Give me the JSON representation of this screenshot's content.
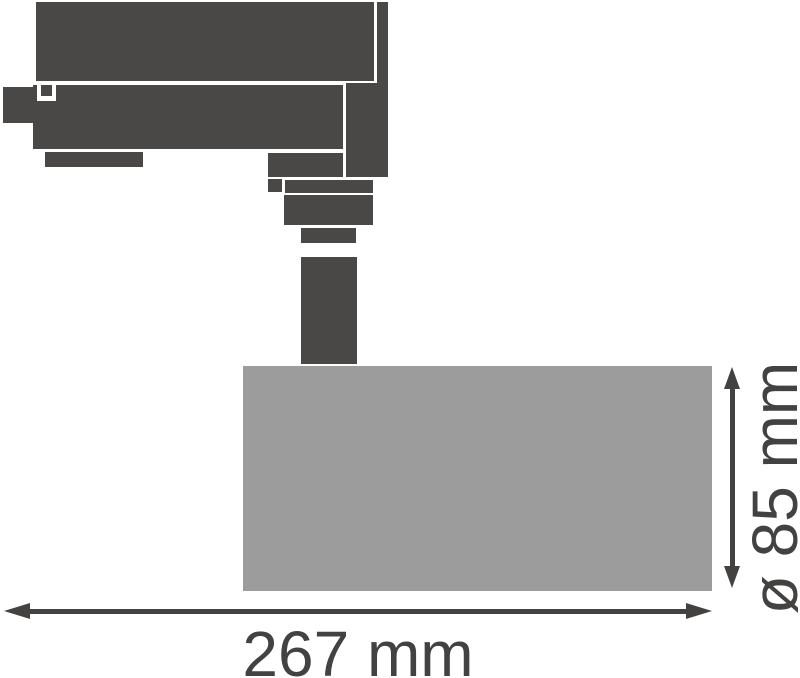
{
  "drawing": {
    "kind": "technical dimension drawing",
    "subject": "track spotlight side view"
  },
  "dimensions": {
    "length": {
      "label": "267 mm",
      "value": 267,
      "unit": "mm"
    },
    "diameter": {
      "label": "ø 85 mm",
      "value": 85,
      "unit": "mm",
      "symbol": "ø"
    }
  },
  "colors": {
    "fixture_dark": "#4a4846",
    "head_gray": "#9c9c9c",
    "dimension_color": "#434240",
    "background": "#ffffff"
  }
}
